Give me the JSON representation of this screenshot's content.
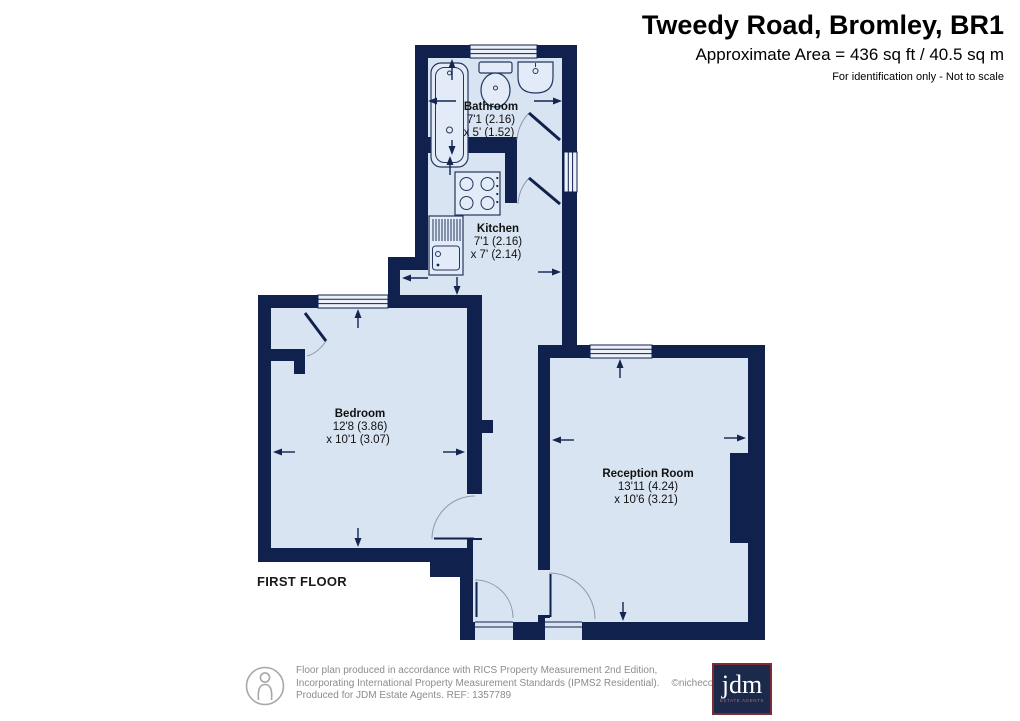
{
  "header": {
    "title": "Tweedy Road, Bromley, BR1",
    "area": "Approximate Area = 436 sq ft / 40.5 sq m",
    "note": "For identification only - Not to scale"
  },
  "floor_label": "FIRST FLOOR",
  "rooms": {
    "bathroom": {
      "name": "Bathroom",
      "dim1": "7'1 (2.16)",
      "dim2": "x 5' (1.52)"
    },
    "kitchen": {
      "name": "Kitchen",
      "dim1": "7'1 (2.16)",
      "dim2": "x 7' (2.14)"
    },
    "bedroom": {
      "name": "Bedroom",
      "dim1": "12'8 (3.86)",
      "dim2": "x 10'1 (3.07)"
    },
    "reception": {
      "name": "Reception Room",
      "dim1": "13'11 (4.24)",
      "dim2": "x 10'6 (3.21)"
    }
  },
  "footer": {
    "line1": "Floor plan produced in accordance with RICS Property Measurement 2nd Edition,",
    "line2": "Incorporating International Property Measurement Standards (IPMS2 Residential).",
    "credit": "©nichecom 2025.",
    "line3": "Produced for JDM Estate Agents.   REF: 1357789"
  },
  "logo": {
    "brand": "jdm",
    "tagline": "ESTATE AGENTS"
  },
  "colors": {
    "wall": "#10214E",
    "floor": "#D9E4F2",
    "logo_border": "#7E2B38",
    "logo_bg": "#1B2A4A"
  }
}
